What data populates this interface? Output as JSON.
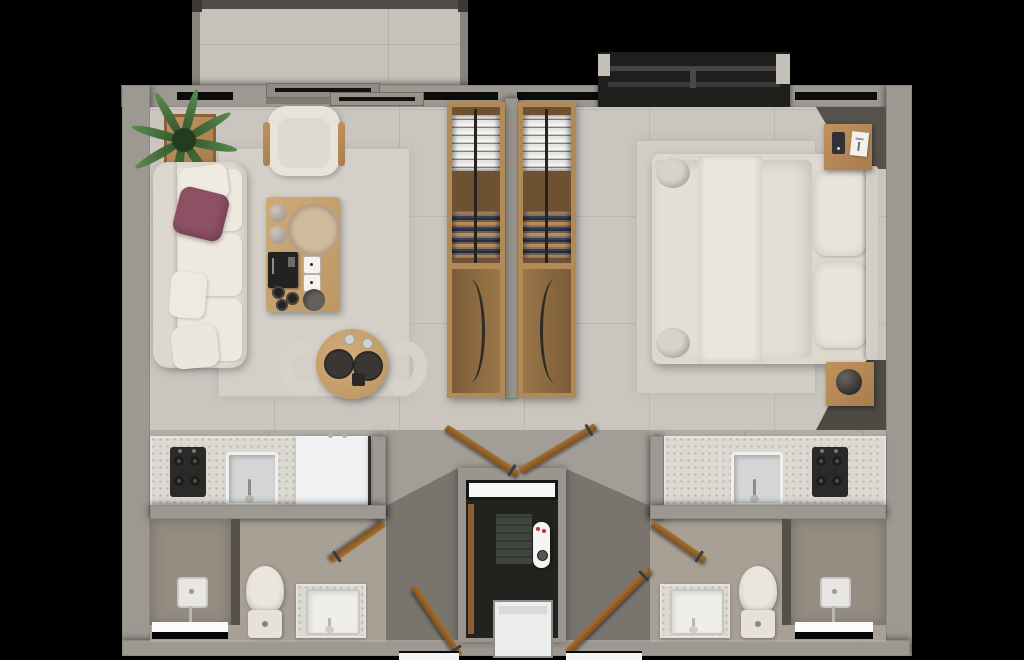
{
  "scene": {
    "kind": "photoreal 3D floor plan render, top-down view",
    "description": "Two mirrored studio suites sharing a central entry hall, twin wardrobe columns and a utility closet",
    "background_color": "#000000"
  },
  "palette": {
    "wall": "#9d9992",
    "floor_main_tile": "#cac6bf",
    "floor_lower": "#b0aca5",
    "floor_hall": "#a29d96",
    "floor_bath": "#a89f95",
    "floor_shower": "#958d81",
    "rug": "#d4d0c9",
    "sofa_cream": "#e8e3d9",
    "accent_pillow": "#8d5164",
    "wood_table": "#c9a470",
    "wood_cabinet": "#b28a58",
    "wood_door": "#9a6a38",
    "plant_green": "#4a7040",
    "counter_terrazzo": "#dcd9d3",
    "appliance_white": "#eff1f2",
    "cooktop_black": "#2b2a28",
    "service_ledge_dark": "#1e1e1d",
    "window_slit": "#0b0b0b",
    "bath_window_white": "#fbfbf9"
  },
  "exterior": {
    "balcony": [
      "railing",
      "tile-floor"
    ],
    "service_ledge": [
      "dark-box",
      "inner-rails",
      "end-caps"
    ],
    "sliding_door": [
      "two-glass-panels",
      "track"
    ]
  },
  "left_suite": {
    "living_room": [
      "sofa",
      "white-throw-pillows",
      "purple-accent-pillow",
      "potted-plant",
      "armchair",
      "coffee-table",
      "decor-tray",
      "decor-book",
      "decor-dice",
      "decor-bowls",
      "round-dining-table",
      "two-plates",
      "two-dining-chairs",
      "area-rug"
    ],
    "kitchenette": [
      "four-burner-cooktop",
      "sink",
      "refrigerator",
      "terrazzo-counter"
    ],
    "bathroom": [
      "walk-in-shower",
      "shower-head",
      "glass-divider",
      "toilet",
      "terrazzo-vanity-with-sink",
      "frosted-window"
    ]
  },
  "core": {
    "wardrobe_left": [
      "hanging-white-shirts",
      "hanging-colored-clothes",
      "center-rail",
      "lower-cabinet-with-bow-handle"
    ],
    "wardrobe_right": [
      "hanging-white-shirts",
      "hanging-colored-clothes",
      "center-rail",
      "lower-cabinet-with-bow-handle"
    ],
    "utility_closet": [
      "white-shelf",
      "towel-stack",
      "tankless-water-heater",
      "washing-machine"
    ],
    "doors": [
      "left-entry-door",
      "right-entry-door",
      "left-bath-hall-door",
      "right-bath-hall-door",
      "left-bath-inner-door",
      "right-bath-inner-door"
    ]
  },
  "right_suite": {
    "bedroom": [
      "double-bed",
      "duvet",
      "runner-blanket",
      "two-pillows",
      "rolled-cushions",
      "headboard",
      "nightstand-top",
      "phone",
      "card",
      "nightstand-bottom",
      "sphere-lamp",
      "area-rug"
    ],
    "kitchenette": [
      "sink",
      "four-burner-cooktop",
      "terrazzo-counter"
    ],
    "bathroom": [
      "terrazzo-vanity-with-sink",
      "toilet",
      "walk-in-shower",
      "shower-head",
      "glass-divider",
      "frosted-window"
    ]
  }
}
